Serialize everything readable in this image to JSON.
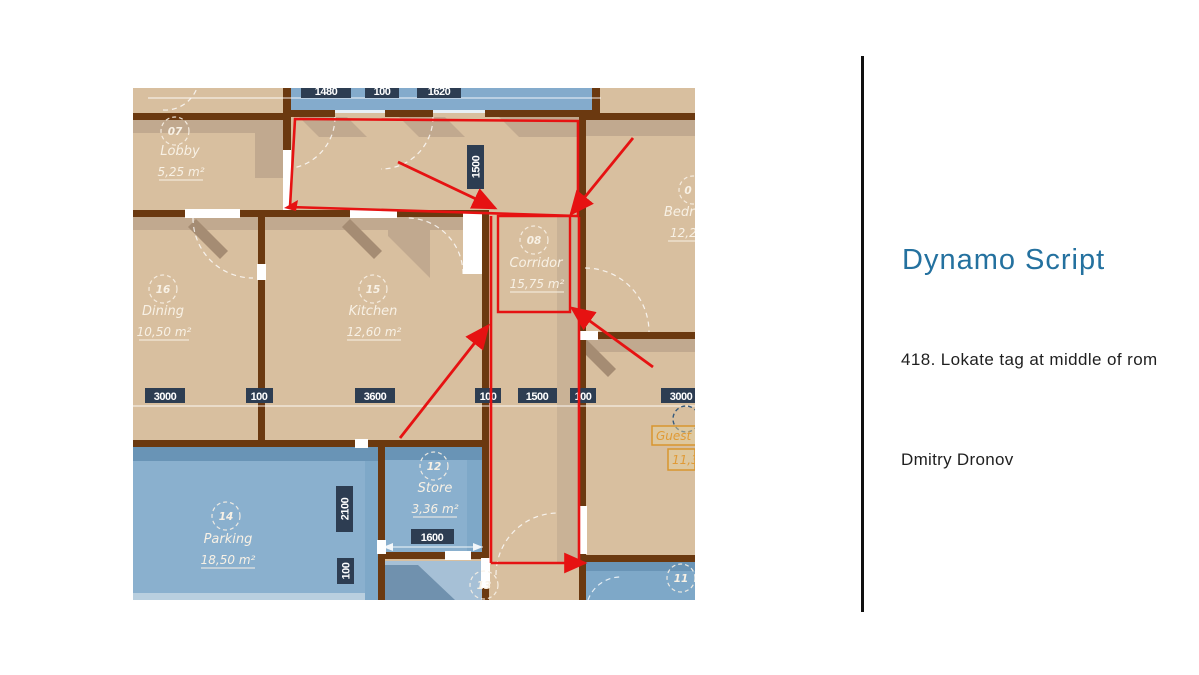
{
  "right_panel": {
    "title": "Dynamo Script",
    "subtitle": "418. Lokate tag at middle of rom",
    "author": "Dmitry Dronov"
  },
  "floor_plan": {
    "rooms": [
      {
        "number": "07",
        "name": "Lobby",
        "area": "5,25 m²"
      },
      {
        "number": "16",
        "name": "Dining",
        "area": "10,50 m²"
      },
      {
        "number": "15",
        "name": "Kitchen",
        "area": "12,60 m²"
      },
      {
        "number": "08",
        "name": "Corridor",
        "area": "15,75 m²"
      },
      {
        "number": "0",
        "name": "Bedr",
        "area": "12,2"
      },
      {
        "number": "12",
        "name": "Store",
        "area": "3,36 m²"
      },
      {
        "number": "14",
        "name": "Parking",
        "area": "18,50 m²"
      },
      {
        "number": "13"
      },
      {
        "number": "11"
      }
    ],
    "dims": {
      "top": [
        "1480",
        "100",
        "1620"
      ],
      "vertical_top": "1500",
      "middle": [
        "3000",
        "100",
        "3600",
        "100",
        "1500",
        "100",
        "3000"
      ],
      "vertical_parking": "2100",
      "vertical_parking_small": "100",
      "store_width": "1600"
    },
    "highlight_tag": {
      "name": "Guest",
      "area": "11,3"
    },
    "colors": {
      "floor_tan": "#d8bf9f",
      "floor_blue": "#7ea8c8",
      "wall_brown": "#6b3910",
      "dim_label_bg": "#2d3d52",
      "red_annotation": "#e61212",
      "tag_highlight_orange": "#e09a35",
      "title_blue": "#24719f"
    }
  }
}
